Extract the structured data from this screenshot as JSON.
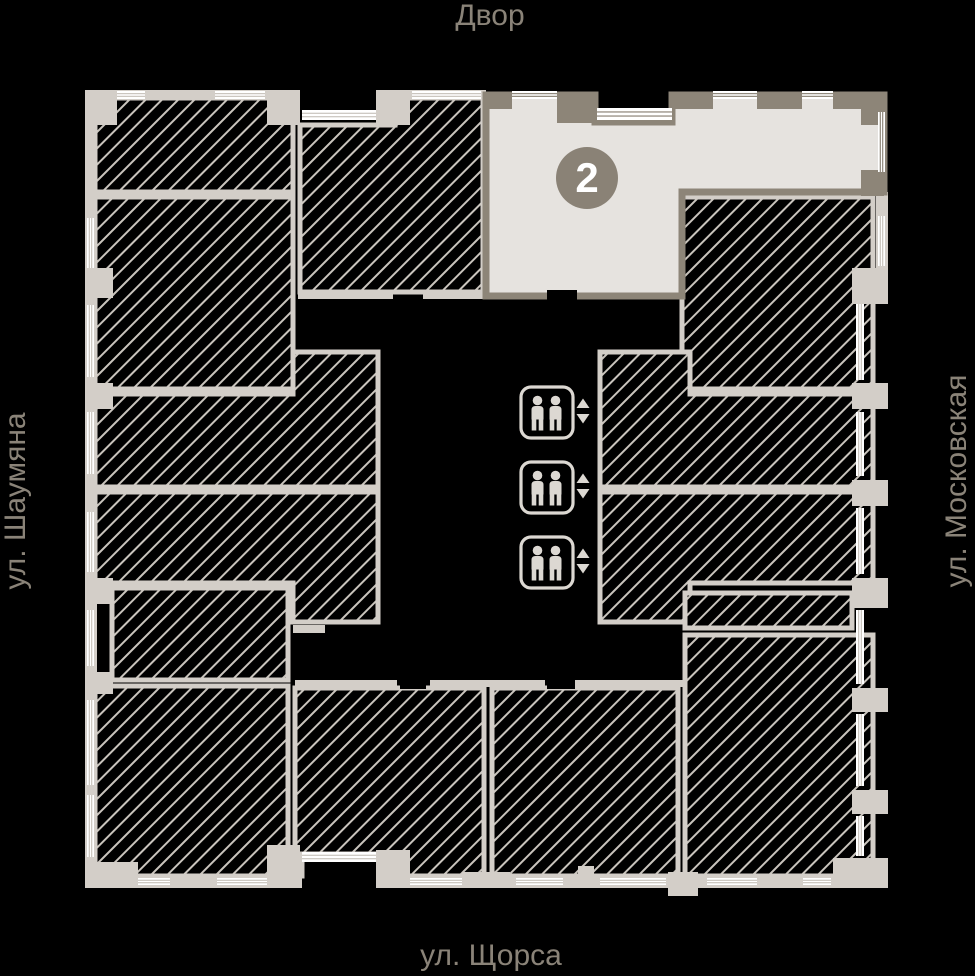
{
  "streets": {
    "top": "Двор",
    "left": "ул. Шаумяна",
    "right": "ул. Московская",
    "bottom": "ул. Щорса",
    "text_color": "#8a8378"
  },
  "selected_unit": {
    "number": "2",
    "floor_color": "#e6e3df",
    "wall_color": "#8d8578",
    "badge_color": "#8a8276",
    "badge_text_color": "#ffffff"
  },
  "palette": {
    "background": "#000000",
    "wall": "#d3cec8",
    "hatch_line": "#c9c4bd",
    "window": "#ffffff",
    "elevator": "#dcd8d2"
  },
  "plan": {
    "hatch": {
      "spacing": 11.5,
      "line_width": 2,
      "angle": -45
    },
    "rooms": [
      {
        "points": [
          [
            95,
            98
          ],
          [
            293,
            98
          ],
          [
            293,
            192
          ],
          [
            95,
            192
          ]
        ]
      },
      {
        "points": [
          [
            95,
            197
          ],
          [
            293,
            197
          ],
          [
            293,
            389
          ],
          [
            95,
            389
          ]
        ]
      },
      {
        "points": [
          [
            95,
            394
          ],
          [
            293,
            394
          ],
          [
            293,
            352
          ],
          [
            378,
            352
          ],
          [
            378,
            487
          ],
          [
            95,
            487
          ]
        ]
      },
      {
        "points": [
          [
            95,
            492
          ],
          [
            378,
            492
          ],
          [
            378,
            622
          ],
          [
            293,
            622
          ],
          [
            293,
            583
          ],
          [
            95,
            583
          ]
        ]
      },
      {
        "points": [
          [
            112,
            588
          ],
          [
            288,
            588
          ],
          [
            288,
            680
          ],
          [
            112,
            680
          ]
        ]
      },
      {
        "points": [
          [
            95,
            686
          ],
          [
            288,
            686
          ],
          [
            288,
            876
          ],
          [
            95,
            876
          ]
        ]
      },
      {
        "points": [
          [
            395,
            98
          ],
          [
            483,
            98
          ],
          [
            483,
            292
          ],
          [
            300,
            292
          ],
          [
            300,
            125
          ],
          [
            395,
            125
          ]
        ]
      },
      {
        "points": [
          [
            682,
            197
          ],
          [
            873,
            197
          ],
          [
            873,
            389
          ],
          [
            682,
            389
          ]
        ]
      },
      {
        "points": [
          [
            600,
            352
          ],
          [
            690,
            352
          ],
          [
            690,
            394
          ],
          [
            873,
            394
          ],
          [
            873,
            487
          ],
          [
            600,
            487
          ]
        ]
      },
      {
        "points": [
          [
            600,
            492
          ],
          [
            873,
            492
          ],
          [
            873,
            583
          ],
          [
            690,
            583
          ],
          [
            690,
            622
          ],
          [
            600,
            622
          ]
        ]
      },
      {
        "points": [
          [
            685,
            593
          ],
          [
            852,
            593
          ],
          [
            852,
            628
          ],
          [
            685,
            628
          ]
        ]
      },
      {
        "points": [
          [
            685,
            635
          ],
          [
            873,
            635
          ],
          [
            873,
            876
          ],
          [
            685,
            876
          ]
        ]
      },
      {
        "points": [
          [
            295,
            688
          ],
          [
            484,
            688
          ],
          [
            484,
            876
          ],
          [
            380,
            876
          ],
          [
            380,
            854
          ],
          [
            302,
            854
          ],
          [
            302,
            876
          ],
          [
            295,
            876
          ]
        ]
      },
      {
        "points": [
          [
            492,
            688
          ],
          [
            678,
            688
          ],
          [
            678,
            876
          ],
          [
            492,
            876
          ]
        ]
      }
    ],
    "corridor_walls": [
      [
        298,
        292,
        95,
        7
      ],
      [
        423,
        292,
        62,
        7
      ],
      [
        293,
        625,
        32,
        8
      ],
      [
        295,
        680,
        102,
        7
      ],
      [
        430,
        680,
        115,
        7
      ],
      [
        575,
        680,
        112,
        7
      ]
    ],
    "outer": {
      "bands": [
        [
          85,
          90,
          215,
          10
        ],
        [
          380,
          90,
          106,
          10
        ],
        [
          85,
          90,
          12,
          786
        ],
        [
          85,
          876,
          217,
          12
        ],
        [
          378,
          876,
          510,
          12
        ],
        [
          876,
          192,
          12,
          112
        ]
      ],
      "piers": [
        [
          85,
          90,
          32,
          35
        ],
        [
          267,
          90,
          33,
          35
        ],
        [
          376,
          90,
          34,
          35
        ],
        [
          85,
          268,
          28,
          30
        ],
        [
          85,
          383,
          28,
          26
        ],
        [
          85,
          578,
          28,
          26
        ],
        [
          85,
          672,
          28,
          22
        ],
        [
          85,
          862,
          53,
          26
        ],
        [
          267,
          845,
          33,
          43
        ],
        [
          376,
          850,
          34,
          38
        ],
        [
          462,
          872,
          48,
          16
        ],
        [
          578,
          866,
          16,
          22
        ],
        [
          668,
          872,
          30,
          24
        ],
        [
          780,
          874,
          22,
          14
        ],
        [
          833,
          858,
          55,
          30
        ],
        [
          852,
          268,
          36,
          36
        ],
        [
          852,
          383,
          36,
          26
        ],
        [
          852,
          480,
          36,
          26
        ],
        [
          852,
          578,
          36,
          30
        ],
        [
          852,
          688,
          36,
          24
        ],
        [
          852,
          790,
          36,
          24
        ]
      ],
      "windows": [
        [
          117,
          91,
          28,
          8
        ],
        [
          215,
          91,
          50,
          8
        ],
        [
          412,
          91,
          69,
          8
        ],
        [
          87,
          218,
          7,
          50
        ],
        [
          87,
          305,
          7,
          72
        ],
        [
          87,
          412,
          7,
          62
        ],
        [
          87,
          512,
          7,
          60
        ],
        [
          87,
          610,
          7,
          56
        ],
        [
          87,
          700,
          7,
          85
        ],
        [
          87,
          795,
          7,
          62
        ],
        [
          856,
          304,
          8,
          76
        ],
        [
          856,
          412,
          8,
          64
        ],
        [
          856,
          508,
          8,
          66
        ],
        [
          856,
          610,
          8,
          74
        ],
        [
          856,
          714,
          8,
          72
        ],
        [
          856,
          816,
          8,
          40
        ],
        [
          878,
          216,
          7,
          50
        ],
        [
          138,
          878,
          32,
          7
        ],
        [
          217,
          878,
          50,
          7
        ],
        [
          410,
          878,
          52,
          7
        ],
        [
          516,
          878,
          47,
          7
        ],
        [
          600,
          878,
          66,
          7
        ],
        [
          707,
          878,
          50,
          7
        ],
        [
          803,
          878,
          28,
          7
        ]
      ],
      "inner_windows": [
        [
          302,
          110,
          74,
          10
        ],
        [
          302,
          852,
          74,
          10
        ]
      ]
    },
    "unit2": {
      "points": [
        [
          486,
          95
        ],
        [
          595,
          95
        ],
        [
          595,
          122
        ],
        [
          672,
          122
        ],
        [
          672,
          95
        ],
        [
          884,
          95
        ],
        [
          884,
          192
        ],
        [
          682,
          192
        ],
        [
          682,
          296
        ],
        [
          486,
          296
        ]
      ],
      "windows": [
        [
          512,
          91,
          45,
          8
        ],
        [
          597,
          108,
          75,
          12
        ],
        [
          713,
          91,
          44,
          8
        ],
        [
          802,
          91,
          31,
          8
        ],
        [
          878,
          112,
          7,
          60
        ]
      ],
      "piers": [
        [
          486,
          95,
          26,
          14
        ],
        [
          557,
          95,
          40,
          28
        ],
        [
          672,
          95,
          41,
          14
        ],
        [
          757,
          95,
          45,
          14
        ],
        [
          833,
          95,
          52,
          14
        ],
        [
          861,
          95,
          23,
          30
        ],
        [
          861,
          170,
          23,
          26
        ]
      ],
      "door_gaps": [
        [
          547,
          290,
          30,
          10
        ]
      ]
    },
    "black_gaps": [
      [
        400,
        679,
        26,
        10
      ],
      [
        547,
        679,
        28,
        10
      ]
    ],
    "elevators": {
      "x": 521,
      "w": 52,
      "h": 51,
      "ys": [
        387,
        462,
        537
      ],
      "arrow_cx": 583
    },
    "badge": {
      "cx": 587,
      "cy": 178,
      "r": 31
    }
  }
}
